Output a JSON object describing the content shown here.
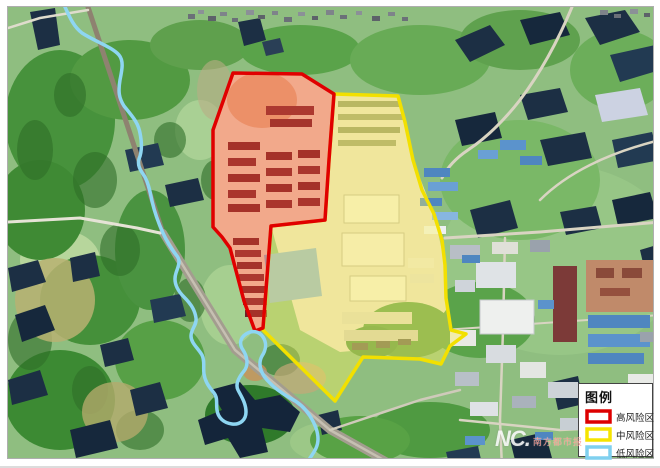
{
  "legend": {
    "title": "图例",
    "items": [
      {
        "id": "high-risk",
        "label": "高风险区",
        "color": "#dd0000"
      },
      {
        "id": "medium-risk",
        "label": "中风险区",
        "color": "#f5e400"
      },
      {
        "id": "low-risk",
        "label": "低风险区",
        "color": "#7fd0ef"
      }
    ]
  },
  "zones": {
    "high": {
      "label": "高风险区",
      "stroke": "#e00000",
      "fill": "rgba(255,82,45,0.38)"
    },
    "medium": {
      "label": "中风险区",
      "stroke": "#f2e000",
      "fill": "rgba(255,242,90,0.38)"
    },
    "low": {
      "label": "低风险区",
      "stroke": "#8ed6f2"
    }
  },
  "watermark": {
    "logo": "NC.",
    "text": "南方都市报"
  }
}
